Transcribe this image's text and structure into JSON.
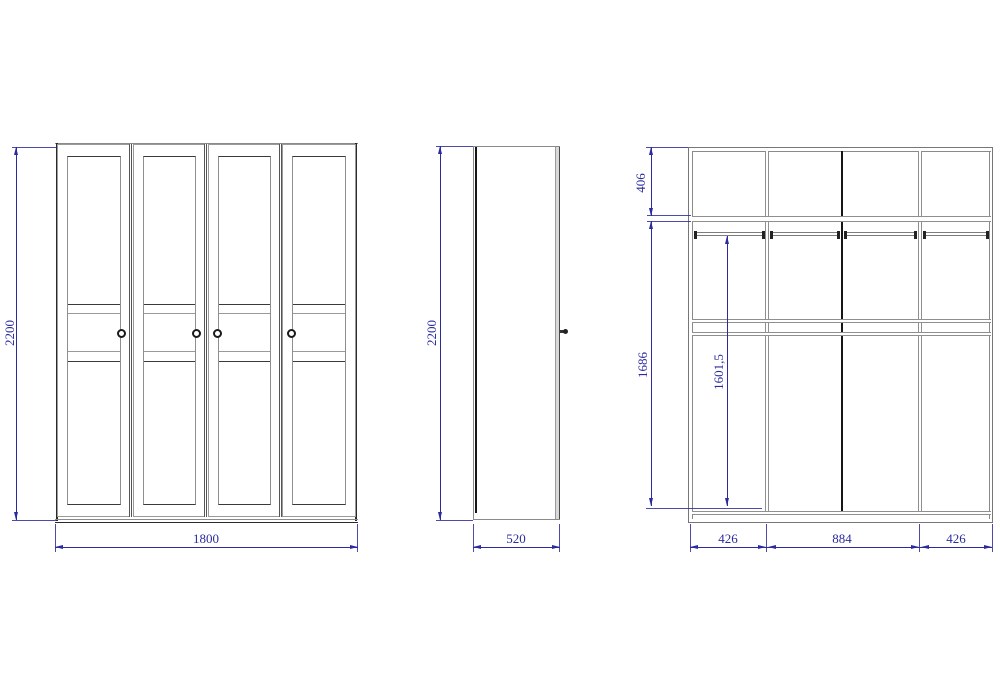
{
  "drawing": {
    "type": "wardrobe-technical-drawing",
    "front_view": {
      "height_dim": "2200",
      "width_dim": "1800"
    },
    "side_view": {
      "height_dim": "2200",
      "depth_dim": "520"
    },
    "interior_view": {
      "top_section_dim": "406",
      "interior_height_dim": "1686",
      "rail_height_dim": "1601,5",
      "bay_width_dims": {
        "left": "426",
        "middle": "884",
        "right": "426"
      }
    },
    "colors": {
      "dimension_blue": "#2b2b9e",
      "outline_gray": "#8a8a8a",
      "accent_dark": "#2a2a2a",
      "partition_black": "#161616"
    }
  }
}
